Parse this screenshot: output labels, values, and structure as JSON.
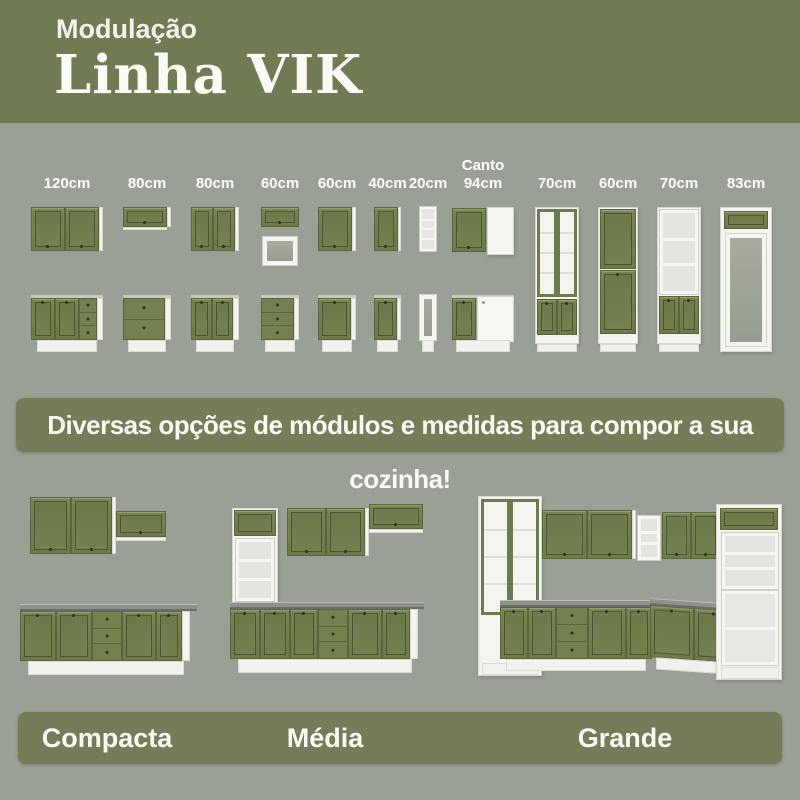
{
  "header": {
    "kicker": "Modulação",
    "title": "Linha VIK"
  },
  "modules": {
    "items": [
      {
        "label": "120cm"
      },
      {
        "label": "80cm"
      },
      {
        "label": "80cm"
      },
      {
        "label": "60cm"
      },
      {
        "label": "60cm"
      },
      {
        "label": "40cm"
      },
      {
        "label": "20cm"
      },
      {
        "label": "Canto 94cm",
        "line1": "Canto",
        "line2": "94cm"
      },
      {
        "label": "70cm"
      },
      {
        "label": "60cm"
      },
      {
        "label": "70cm"
      },
      {
        "label": "83cm"
      }
    ]
  },
  "banner": {
    "text": "Diversas opções de módulos e medidas para compor a sua cozinha!"
  },
  "kitchens": {
    "items": [
      {
        "label": "Compacta"
      },
      {
        "label": "Média"
      },
      {
        "label": "Grande"
      }
    ]
  },
  "colors": {
    "header_green": "#717b53",
    "panel_green": "#747d57",
    "background_gray": "#9aa095",
    "cabinet_green": "#74804e",
    "cabinet_white": "#f4f4f1",
    "countertop_gray": "#8f928a",
    "text_white": "#fafaf5"
  }
}
